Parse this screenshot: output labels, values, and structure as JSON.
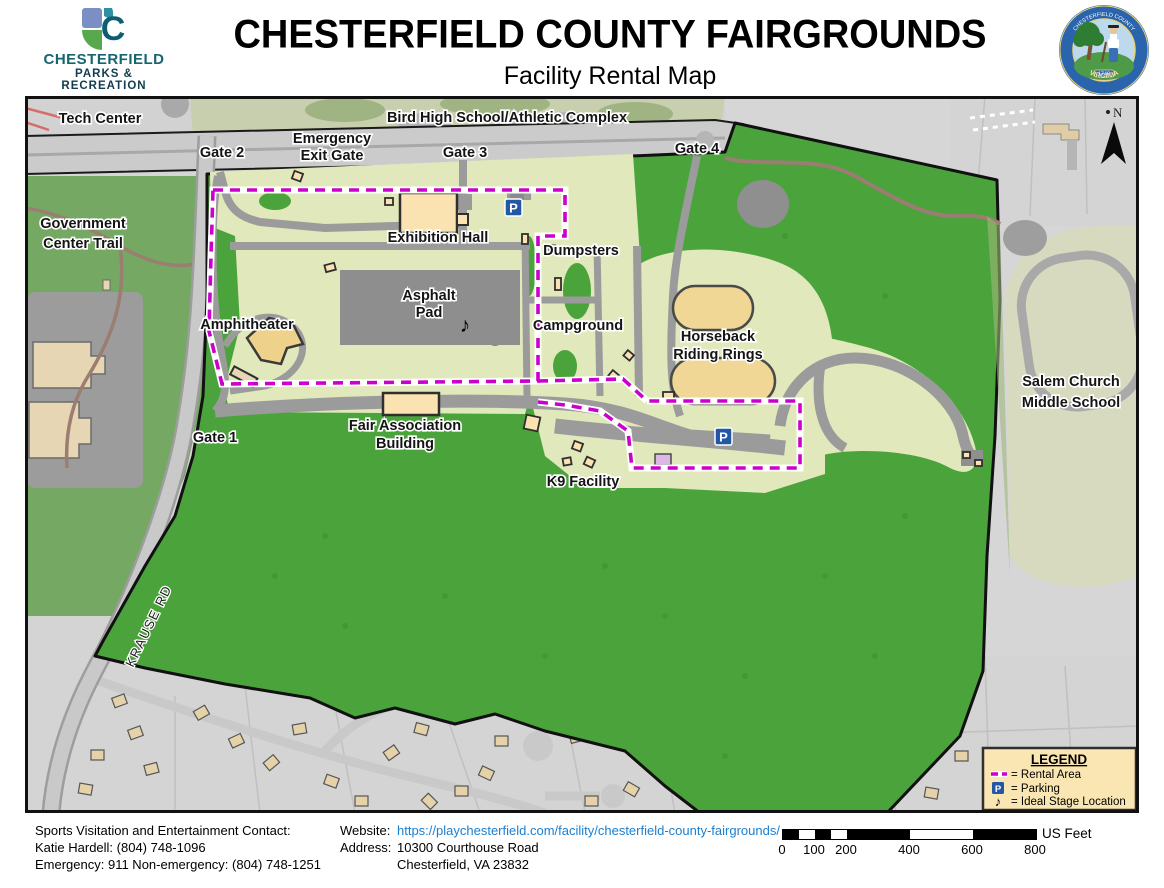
{
  "header": {
    "logo_mark_letter": "C",
    "logo_line1": "CHESTERFIELD",
    "logo_line2": "PARKS &",
    "logo_line3": "RECREATION",
    "title": "CHESTERFIELD COUNTY FAIRGROUNDS",
    "subtitle": "Facility Rental Map",
    "seal_top": "CHESTERFIELD COUNTY",
    "seal_bottom": "VIRGINIA",
    "seal_year": "1749"
  },
  "map": {
    "labels": {
      "tech_center": "Tech Center",
      "bird_high_school": "Bird High School/Athletic Complex",
      "gate_2": "Gate 2",
      "emergency_exit_1": "Emergency",
      "emergency_exit_2": "Exit Gate",
      "gate_3": "Gate 3",
      "gate_4": "Gate 4",
      "government_trail_1": "Government",
      "government_trail_2": "Center Trail",
      "exhibition_hall": "Exhibition Hall",
      "dumpsters": "Dumpsters",
      "asphalt_pad_1": "Asphalt",
      "asphalt_pad_2": "Pad",
      "amphitheater": "Amphitheater",
      "campground": "Campground",
      "horseback_1": "Horseback",
      "horseback_2": "Riding Rings",
      "salem_church_1": "Salem Church",
      "salem_church_2": "Middle School",
      "gate_1": "Gate 1",
      "fair_association_1": "Fair Association",
      "fair_association_2": "Building",
      "k9_facility": "K9 Facility",
      "krause_rd": "KRAUSE RD",
      "north_letter": "N"
    },
    "parking_glyph": "P",
    "stage_glyph": "♪",
    "legend": {
      "title": "LEGEND",
      "item_rental": "= Rental Area",
      "item_parking": "= Parking",
      "item_stage": "= Ideal Stage Location"
    },
    "colors": {
      "rental_dash": "#cc00cc",
      "parking_blue": "#2257a5",
      "fairground_green": "#4ba33c",
      "interior_pale": "#e1e8bb",
      "building_tan": "#fae3b0",
      "legend_bg": "#fae6b2"
    }
  },
  "footer": {
    "contact_line1": "Sports Visitation and Entertainment Contact:",
    "contact_line2": "Katie Hardell: (804) 748-1096",
    "contact_line3": "Emergency: 911 Non-emergency: (804) 748-1251",
    "website_label": "Website:",
    "website_url": "https://playchesterfield.com/facility/chesterfield-county-fairgrounds/",
    "address_label": "Address:",
    "address_line1": "10300 Courthouse Road",
    "address_line2": "Chesterfield, VA 23832",
    "scale_ticks": [
      "0",
      "100",
      "200",
      "400",
      "600",
      "800"
    ],
    "scale_units": "US Feet"
  }
}
